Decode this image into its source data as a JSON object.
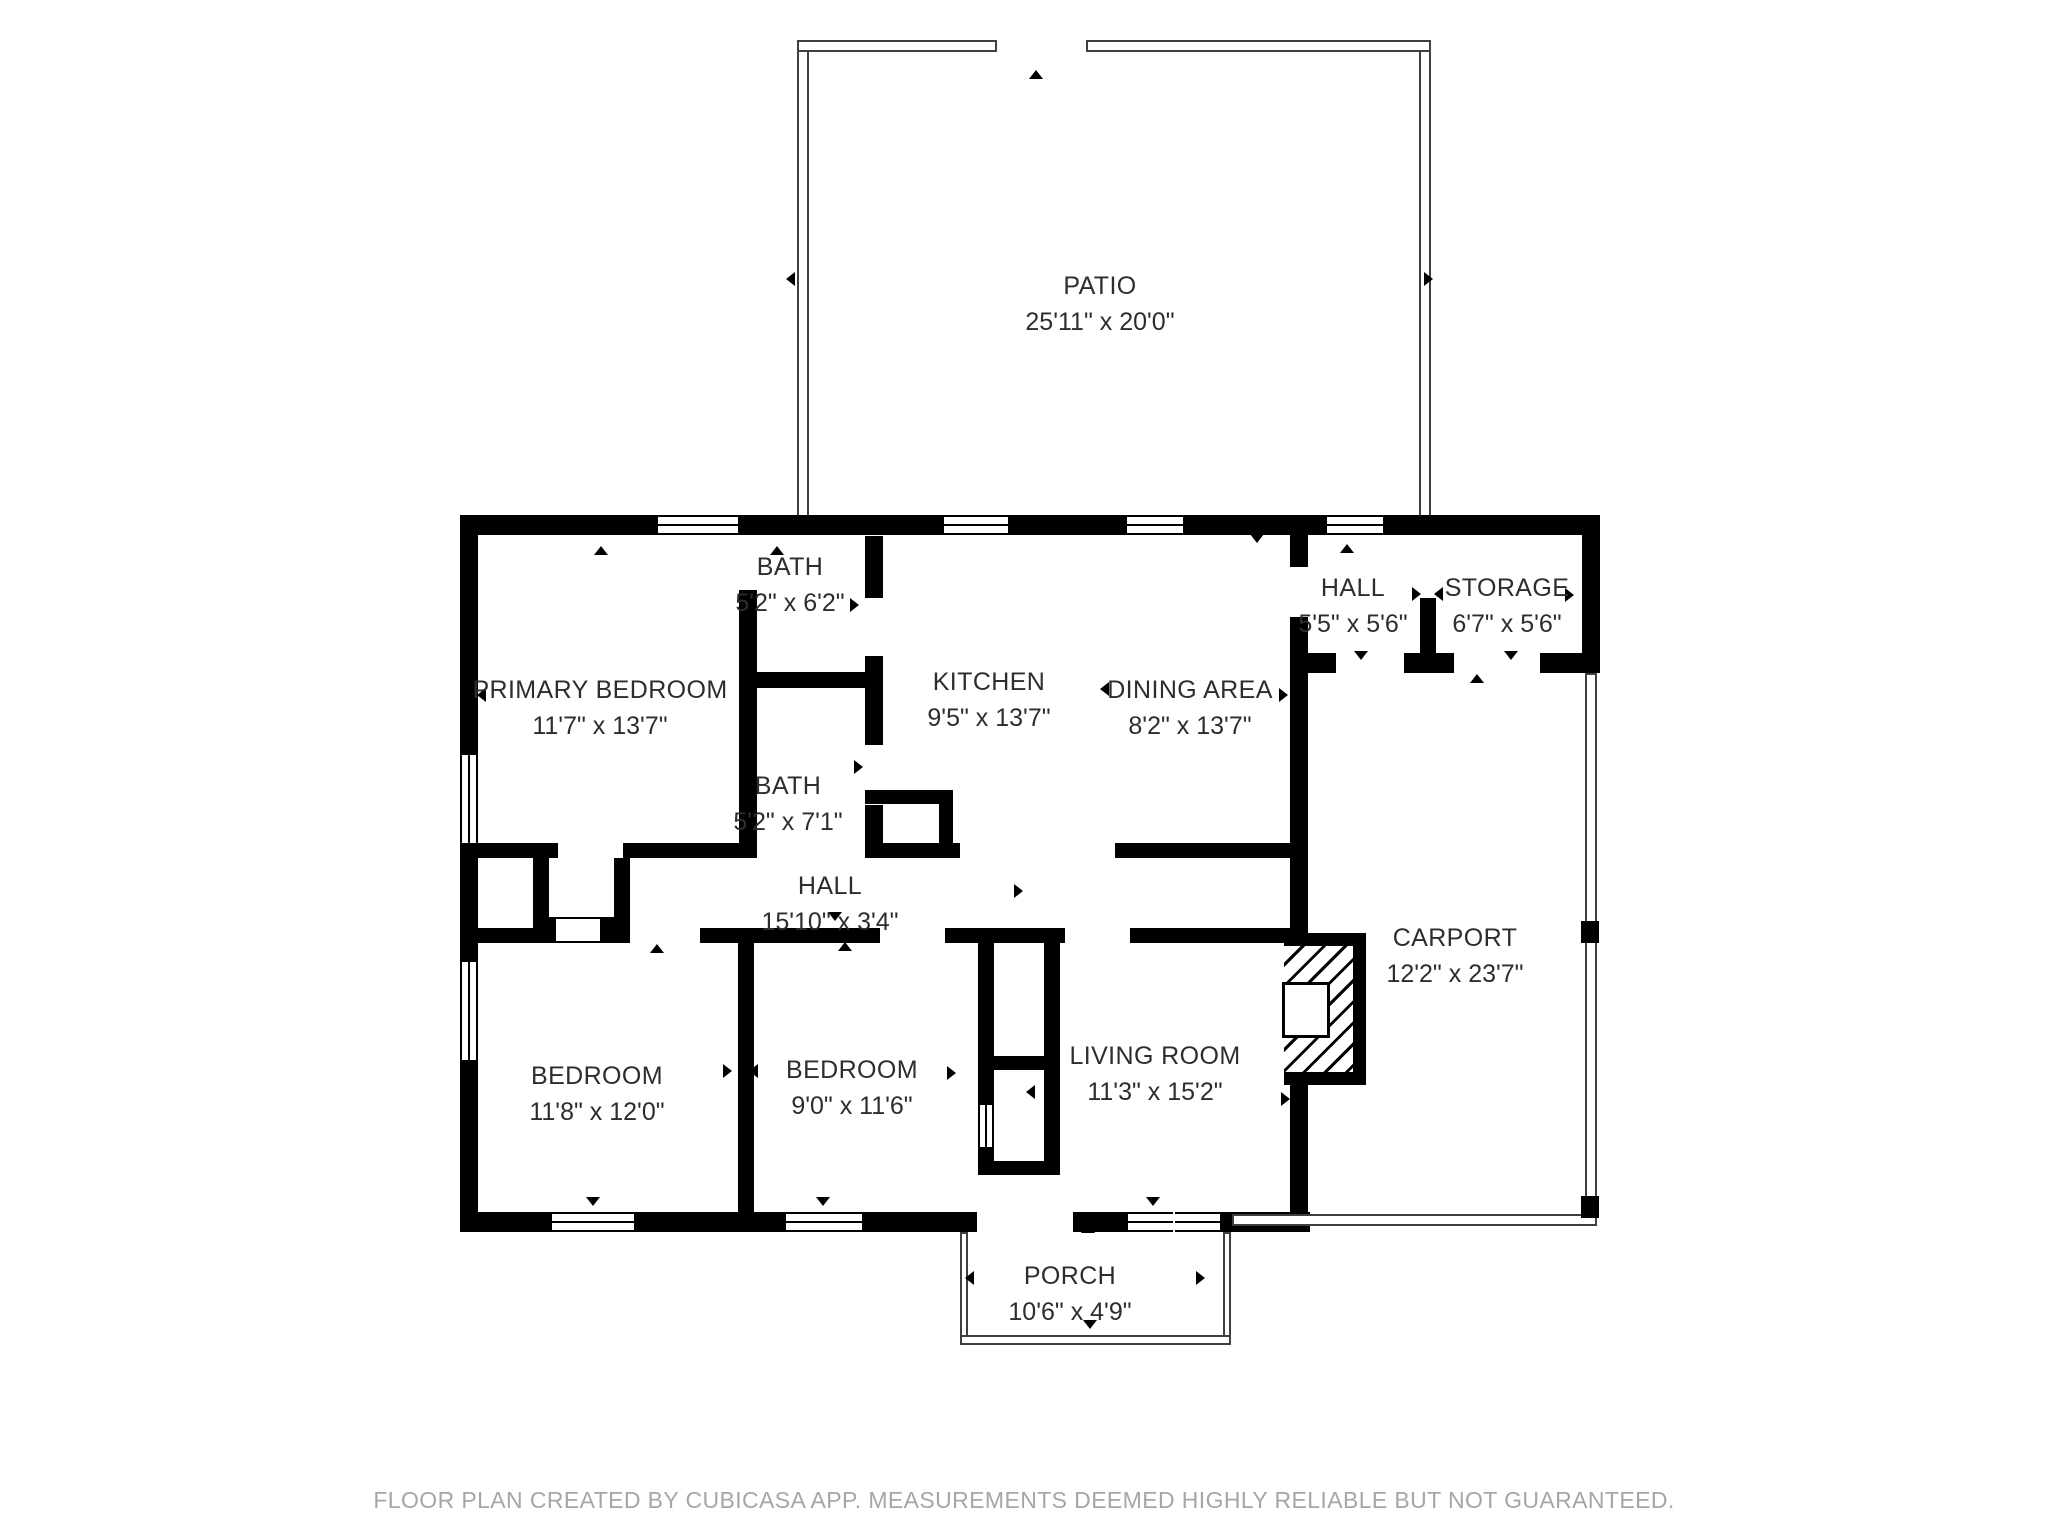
{
  "colors": {
    "wall": "#000000",
    "label": "#2d2d2d",
    "footer": "#a6a6a6",
    "background": "#ffffff"
  },
  "rooms": {
    "patio": {
      "name": "PATIO",
      "dims": "25'11\" x 20'0\""
    },
    "bath1": {
      "name": "BATH",
      "dims": "5'2\" x 6'2\""
    },
    "primary_bedroom": {
      "name": "PRIMARY BEDROOM",
      "dims": "11'7\" x 13'7\""
    },
    "kitchen": {
      "name": "KITCHEN",
      "dims": "9'5\" x 13'7\""
    },
    "dining": {
      "name": "DINING AREA",
      "dims": "8'2\" x 13'7\""
    },
    "hall_upper": {
      "name": "HALL",
      "dims": "5'5\" x 5'6\""
    },
    "storage": {
      "name": "STORAGE",
      "dims": "6'7\" x 5'6\""
    },
    "bath2": {
      "name": "BATH",
      "dims": "5'2\" x 7'1\""
    },
    "hall": {
      "name": "HALL",
      "dims": "15'10\" x 3'4\""
    },
    "bedroom_left": {
      "name": "BEDROOM",
      "dims": "11'8\" x 12'0\""
    },
    "bedroom_middle": {
      "name": "BEDROOM",
      "dims": "9'0\" x 11'6\""
    },
    "living_room": {
      "name": "LIVING ROOM",
      "dims": "11'3\" x 15'2\""
    },
    "carport": {
      "name": "CARPORT",
      "dims": "12'2\" x 23'7\""
    },
    "porch": {
      "name": "PORCH",
      "dims": "10'6\" x 4'9\""
    }
  },
  "footer": {
    "text": "FLOOR PLAN CREATED BY CUBICASA APP. MEASUREMENTS DEEMED HIGHLY RELIABLE BUT NOT GUARANTEED."
  }
}
